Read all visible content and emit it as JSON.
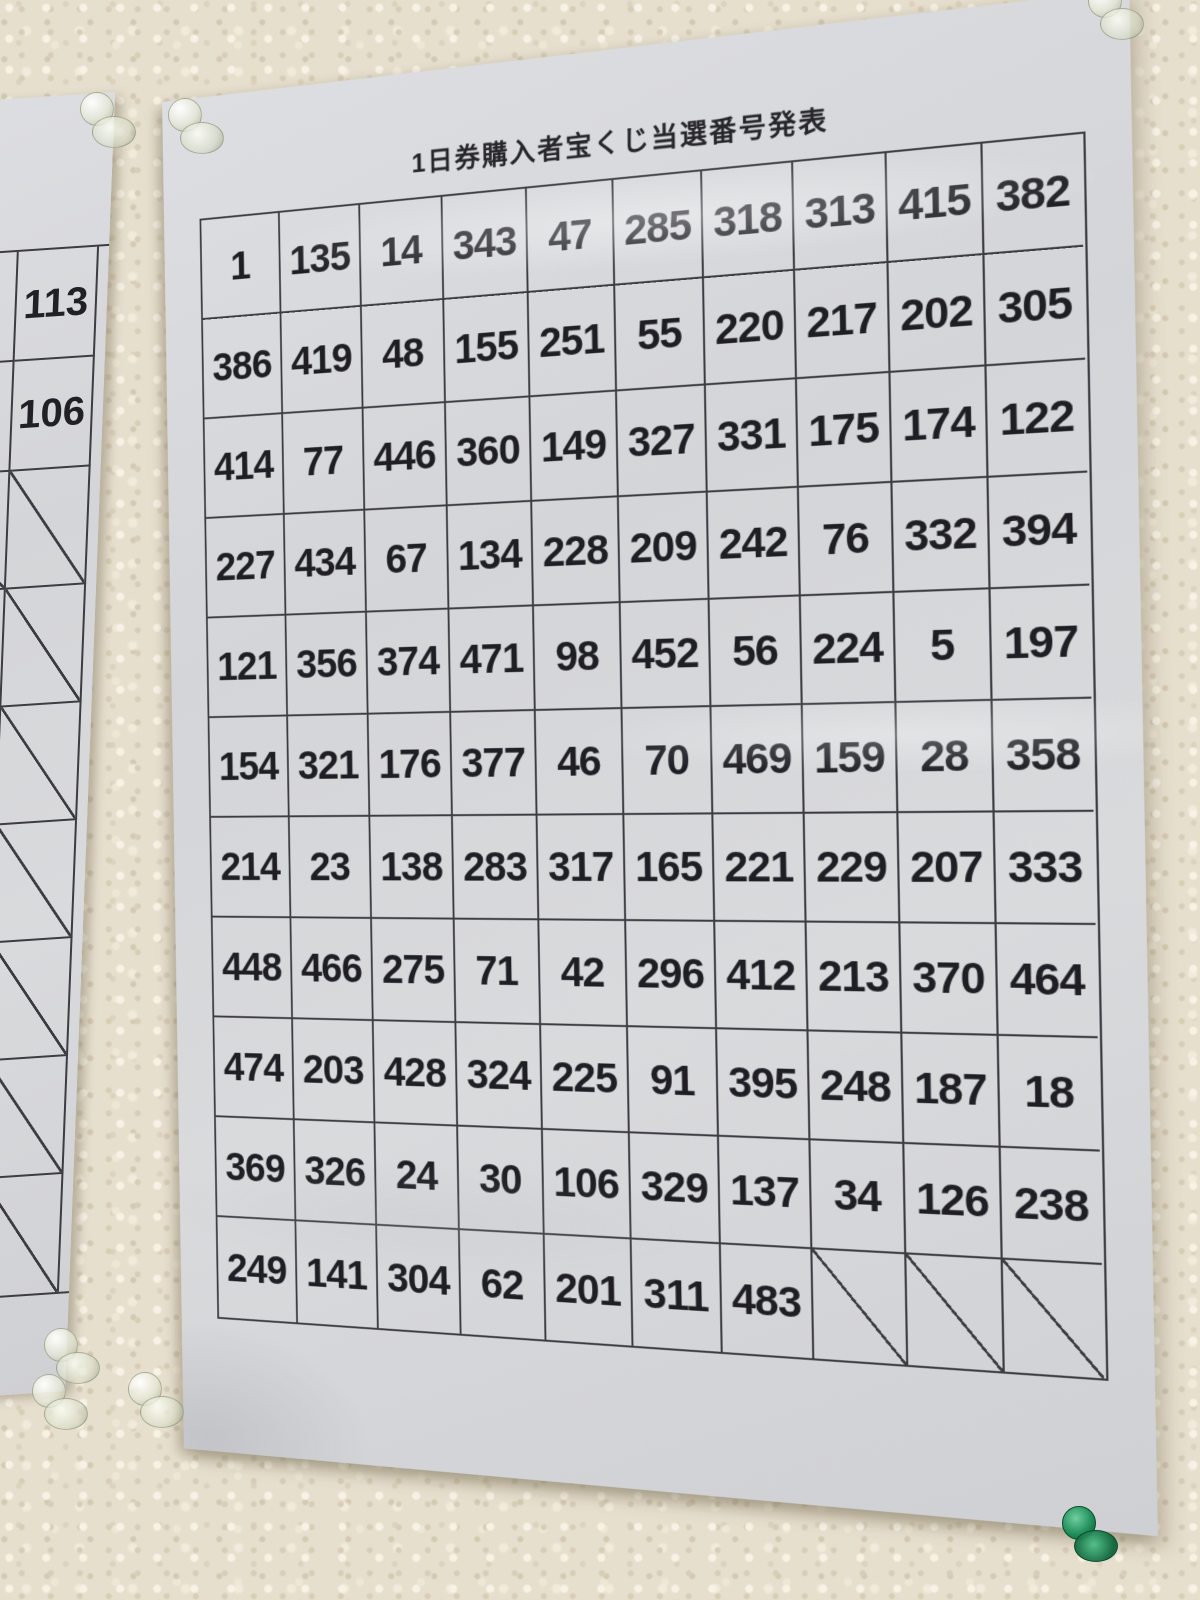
{
  "scene": {
    "wall_color": "#e7dfce",
    "paper_color": "#d6d7da",
    "table_line_color": "#3c3c42",
    "pin_colors": {
      "clear": "rgba(235,238,225,0.85)",
      "green": "#1d8a55"
    }
  },
  "main_sheet": {
    "title": "1日券購入者宝くじ当選番号発表",
    "columns": 10,
    "slashed_cell_marker": "/",
    "rows": [
      [
        "1",
        "135",
        "14",
        "343",
        "47",
        "285",
        "318",
        "313",
        "415",
        "382"
      ],
      [
        "386",
        "419",
        "48",
        "155",
        "251",
        "55",
        "220",
        "217",
        "202",
        "305"
      ],
      [
        "414",
        "77",
        "446",
        "360",
        "149",
        "327",
        "331",
        "175",
        "174",
        "122"
      ],
      [
        "227",
        "434",
        "67",
        "134",
        "228",
        "209",
        "242",
        "76",
        "332",
        "394"
      ],
      [
        "121",
        "356",
        "374",
        "471",
        "98",
        "452",
        "56",
        "224",
        "5",
        "197"
      ],
      [
        "154",
        "321",
        "176",
        "377",
        "46",
        "70",
        "469",
        "159",
        "28",
        "358"
      ],
      [
        "214",
        "23",
        "138",
        "283",
        "317",
        "165",
        "221",
        "229",
        "207",
        "333"
      ],
      [
        "448",
        "466",
        "275",
        "71",
        "42",
        "296",
        "412",
        "213",
        "370",
        "464"
      ],
      [
        "474",
        "203",
        "428",
        "324",
        "225",
        "91",
        "395",
        "248",
        "187",
        "18"
      ],
      [
        "369",
        "326",
        "24",
        "30",
        "106",
        "329",
        "137",
        "34",
        "126",
        "238"
      ],
      [
        "249",
        "141",
        "304",
        "62",
        "201",
        "311",
        "483",
        "/",
        "/",
        "/"
      ]
    ]
  },
  "left_sheet": {
    "visible_rows": [
      [
        "1",
        "113"
      ],
      [
        "2",
        "106"
      ]
    ],
    "slashed_row_count": 7
  }
}
